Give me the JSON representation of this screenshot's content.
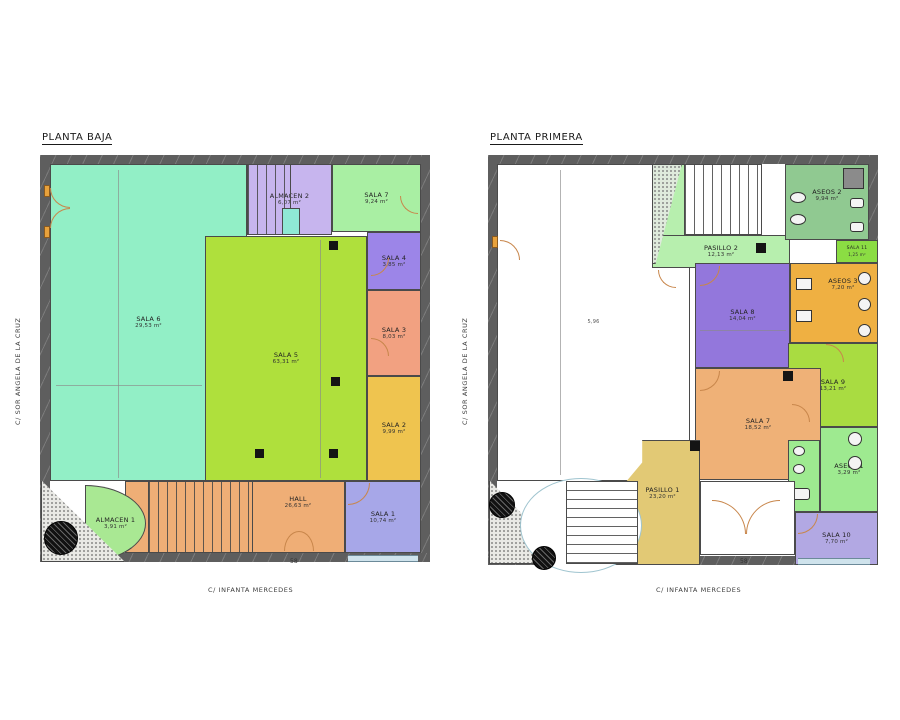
{
  "streets": {
    "left": "C/ SOR ANGELA DE LA CRUZ",
    "bottom": "C/ INFANTA MERCEDES"
  },
  "plans": {
    "baja": {
      "title": "PLANTA BAJA",
      "street_number": "58",
      "rooms": {
        "sala6": {
          "name": "SALA 6",
          "area": "29,53 m²",
          "color": "#92efc6"
        },
        "sala5": {
          "name": "SALA 5",
          "area": "63,31 m²",
          "color": "#afe03c"
        },
        "almacen2": {
          "name": "ALMACEN 2",
          "area": "6,07 m²",
          "color": "#c7b5ee"
        },
        "sala7": {
          "name": "SALA 7",
          "area": "9,24 m²",
          "color": "#a9efa3"
        },
        "sala4": {
          "name": "SALA 4",
          "area": "3,85 m²",
          "color": "#9c85e8"
        },
        "sala3": {
          "name": "SALA 3",
          "area": "8,03 m²",
          "color": "#f2a181"
        },
        "sala2": {
          "name": "SALA 2",
          "area": "9,99 m²",
          "color": "#efc44f"
        },
        "hall": {
          "name": "HALL",
          "area": "26,63 m²",
          "color": "#efae76"
        },
        "almacen1": {
          "name": "ALMACEN 1",
          "area": "3,91 m²",
          "color": "#a9e893"
        },
        "sala1": {
          "name": "SALA 1",
          "area": "10,74 m²",
          "color": "#a7a7e8"
        }
      }
    },
    "primera": {
      "title": "PLANTA PRIMERA",
      "street_number": "58",
      "dims": {
        "white_room_width": "5,96"
      },
      "rooms": {
        "aseos2": {
          "name": "ASEOS 2",
          "area": "9,94 m²",
          "color": "#90c991"
        },
        "pasillo2": {
          "name": "PASILLO 2",
          "area": "12,13 m²",
          "color": "#b7efae"
        },
        "sala11": {
          "name": "SALA 11",
          "area": "1,25 m²",
          "color": "#8bdd43"
        },
        "aseos3": {
          "name": "ASEOS 3",
          "area": "7,20 m²",
          "color": "#efb042"
        },
        "sala8": {
          "name": "SALA 8",
          "area": "14,04 m²",
          "color": "#9377dc"
        },
        "sala9": {
          "name": "SALA 9",
          "area": "13,21 m²",
          "color": "#a9dc41"
        },
        "sala7": {
          "name": "SALA 7",
          "area": "18,52 m²",
          "color": "#efb177"
        },
        "aseos1": {
          "name": "ASEOS 1",
          "area": "3,29 m²",
          "color": "#9eea90"
        },
        "pasillo1": {
          "name": "PASILLO 1",
          "area": "23,20 m²",
          "color": "#e2c975"
        },
        "sala10": {
          "name": "SALA 10",
          "area": "7,70 m²",
          "color": "#b2a8e3"
        }
      }
    }
  },
  "palette": {
    "wall": "#5e5e5e",
    "door": "#c8864b"
  }
}
